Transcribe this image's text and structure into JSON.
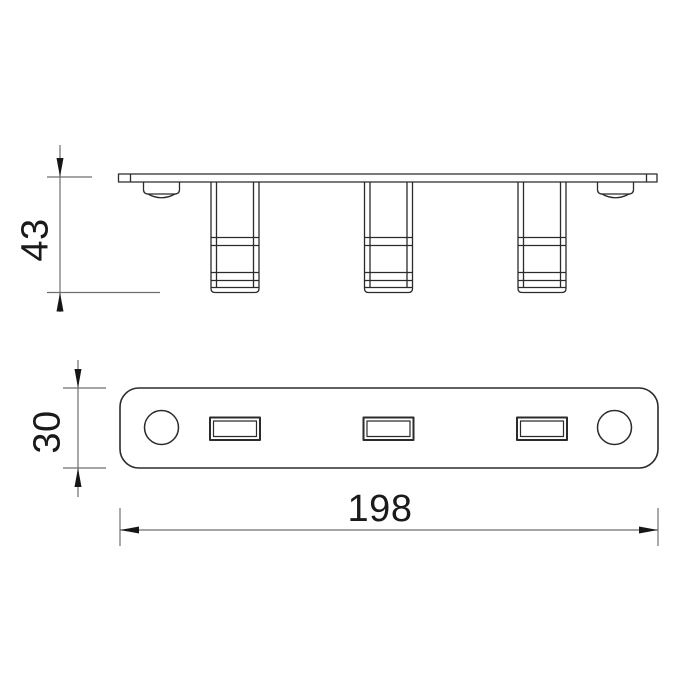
{
  "page": {
    "background": "#ffffff"
  },
  "colors": {
    "drawing_line": "#2b2b2b",
    "dimension_line": "#6f6f6f",
    "arrow": "#161616",
    "text": "#1a1a1a"
  },
  "drawing": {
    "type": "technical-drawing",
    "views": {
      "front_elevation": {
        "description": "side profile of plate with three bent hooks and two dimpled holes",
        "hook_count": 3,
        "dimple_count": 2
      },
      "plan": {
        "description": "rounded rectangular plate face with two round holes and three rectangular slots",
        "round_hole_count": 2,
        "slot_count": 3
      }
    },
    "dimensions": {
      "side_height": {
        "value": "43"
      },
      "plate_width": {
        "value": "30"
      },
      "plate_length": {
        "value": "198"
      }
    }
  }
}
